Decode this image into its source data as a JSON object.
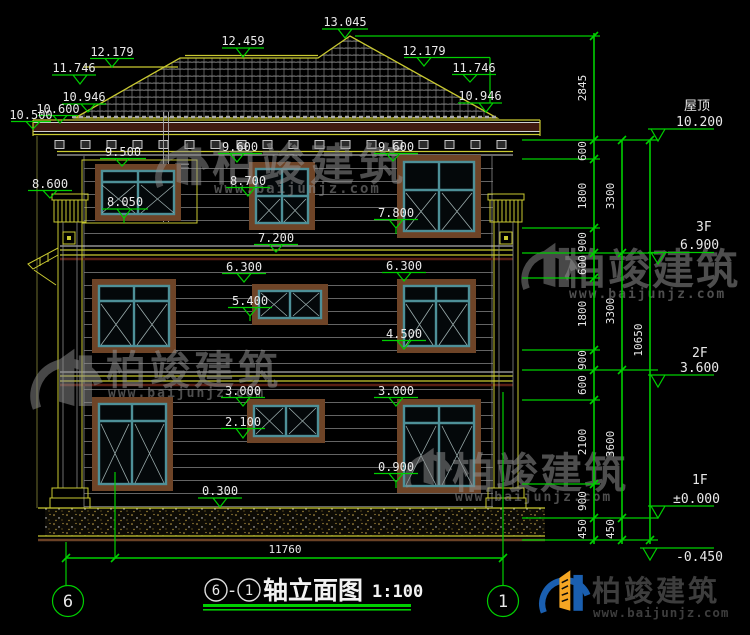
{
  "drawing_title": {
    "axis_left": "6",
    "axis_right": "1",
    "separator": "-",
    "name": "轴立面图",
    "scale": "1:100"
  },
  "grid_bubbles": {
    "left": "6",
    "right": "1"
  },
  "bottom_dimension": "11760",
  "top_marks": [
    {
      "v": "13.045"
    },
    {
      "v": "12.459"
    },
    {
      "v": "12.179"
    },
    {
      "v": "11.746"
    },
    {
      "v": "10.946"
    },
    {
      "v": "10.600"
    },
    {
      "v": "10.500"
    },
    {
      "v": "12.179"
    },
    {
      "v": "11.746"
    },
    {
      "v": "10.946"
    }
  ],
  "wall_marks": [
    {
      "v": "9.500"
    },
    {
      "v": "9.600"
    },
    {
      "v": "9.600"
    },
    {
      "v": "8.700"
    },
    {
      "v": "8.600"
    },
    {
      "v": "8.050"
    },
    {
      "v": "7.800"
    },
    {
      "v": "7.200"
    },
    {
      "v": "6.300"
    },
    {
      "v": "6.300"
    },
    {
      "v": "5.400"
    },
    {
      "v": "4.500"
    },
    {
      "v": "3.000"
    },
    {
      "v": "3.000"
    },
    {
      "v": "2.100"
    },
    {
      "v": "0.900"
    },
    {
      "v": "0.300"
    }
  ],
  "right_levels": [
    {
      "label": "屋顶",
      "value": "10.200"
    },
    {
      "label": "3F",
      "value": "6.900"
    },
    {
      "label": "2F",
      "value": "3.600"
    },
    {
      "label": "1F",
      "value": "±0.000"
    },
    {
      "label": "",
      "value": "-0.450"
    }
  ],
  "dim_chains": {
    "inner": [
      "2845",
      "600",
      "1800",
      "900",
      "600",
      "1800",
      "900",
      "600",
      "2100",
      "900",
      "450"
    ],
    "middle": [
      "3300",
      "3300",
      "3600",
      "450"
    ],
    "outer": [
      "10650"
    ]
  },
  "watermark": {
    "brand": "柏竣建筑",
    "url": "www.baijunjz.com"
  },
  "footer_logo": {
    "brand": "柏竣建筑",
    "url": "www.baijunjz.com"
  }
}
